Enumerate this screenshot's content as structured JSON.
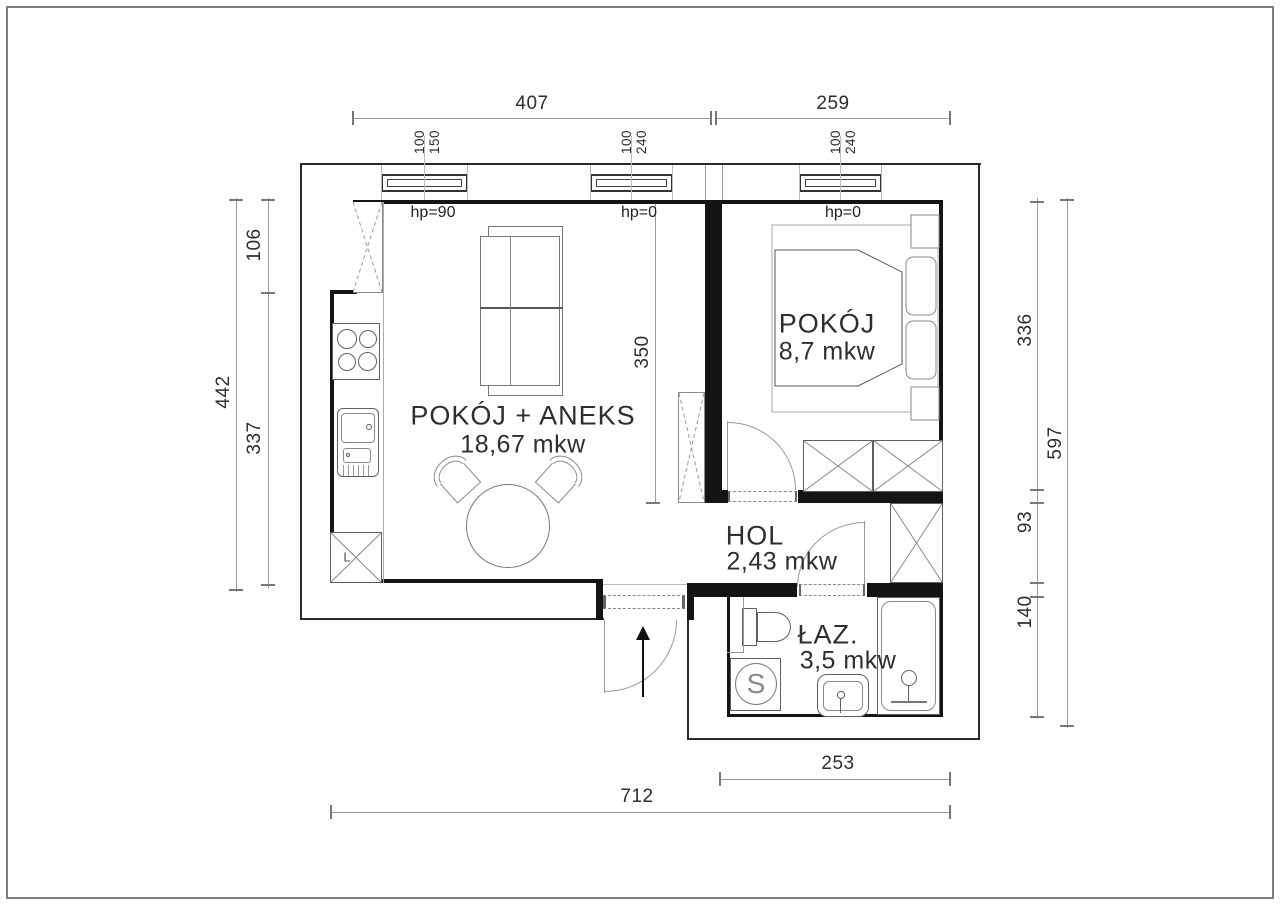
{
  "title": "apartment floor plan",
  "rooms": [
    {
      "name": "POKÓJ + ANEKS",
      "area": "18,67 mkw"
    },
    {
      "name": "POKÓJ",
      "area": "8,7 mkw"
    },
    {
      "name": "HOL",
      "area": "2,43 mkw"
    },
    {
      "name": "ŁAZ.",
      "area": "3,5 mkw"
    }
  ],
  "dims": {
    "top_left": "407",
    "top_right": "259",
    "left_upper": "106",
    "left_outer": "442",
    "left_lower": "337",
    "right_inner_top": "336",
    "right_outer": "597",
    "right_inner_mid": "93",
    "right_inner_bottom": "140",
    "living_depth": "350",
    "bottom_inner": "253",
    "bottom_outer": "712"
  },
  "windows": [
    {
      "width": "100",
      "height": "150"
    },
    {
      "width": "100",
      "height": "240"
    },
    {
      "width": "100",
      "height": "240"
    }
  ],
  "sills": [
    {
      "label": "hp=90"
    },
    {
      "label": "hp=0"
    },
    {
      "label": "hp=0"
    }
  ],
  "marks": {
    "kitchen_corner_unit": "L",
    "washing_machine": "S"
  },
  "colors": {
    "wall": "#141414",
    "furniture": "#606060",
    "dim_line": "#9a9a9a",
    "text": "#2e2e2e",
    "frame": "#7d7d7d"
  }
}
